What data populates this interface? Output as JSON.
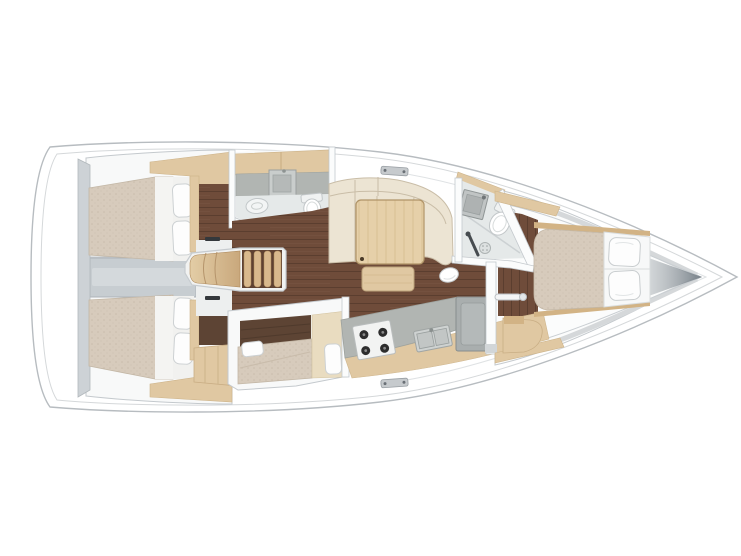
{
  "canvas": {
    "width": 741,
    "height": 556,
    "background": "#ffffff"
  },
  "legend": {
    "vessel": "sailboat-interior-plan-top-view",
    "rooms": [
      "aft-cabin-port",
      "aft-cabin-starboard",
      "aft-head",
      "companionway",
      "salon",
      "midship-cabin",
      "galley",
      "forward-head",
      "forward-cabin"
    ],
    "fixtures": [
      "double-berth",
      "pillow",
      "companionway-steps",
      "toilet",
      "washbasin",
      "shower-drain",
      "settee",
      "saloon-table",
      "bench",
      "stool",
      "stove",
      "galley-sink",
      "fridge",
      "wardrobe",
      "grab-rail",
      "chainplate"
    ]
  },
  "colors": {
    "hull_fill": "#ffffff",
    "hull_outline": "#b7bcc0",
    "deck_line": "#d5d8da",
    "room_fill": "#f8f9f9",
    "wall_fill": "#fbfcfc",
    "wall_stroke": "#c4c9cd",
    "bulkhead": "#cdd2d6",
    "corridor": "#c7cdd1",
    "corridor_light": "#d4d9dc",
    "landing": "#edefef",
    "floor_dark": "#6f4c3a",
    "plank_line": "#5b3e2f",
    "wood_light": "#e0c8a2",
    "wood_pale": "#e9dcc0",
    "wood_mid": "#d2b385",
    "wood_dark": "#5d4434",
    "mattress": "#d7cbbc",
    "mattress_dot": "#c9bcab",
    "linen": "#f4f4f2",
    "pillow": "#fdfdfd",
    "pillow_outline": "#cdd1d3",
    "cushion": "#ece4d3",
    "cushion_seam": "#c9bda7",
    "table_wood": "#e6d0a9",
    "table_grain": "#d8bf94",
    "stair_tread": "#d9b98d",
    "stair_gap": "#5f4232",
    "counter": "#b1b5b2",
    "appliance": "#f2f3f2",
    "burner": "#2d2d2d",
    "sink_gray": "#ced2d1",
    "fridge": "#a9aeae",
    "bath_floor": "#e5e9e9",
    "fixture_stroke": "#c2c7c9",
    "shadow": "#8f979d",
    "hardware": "#c6cacd",
    "handle_dark": "#34383c"
  }
}
